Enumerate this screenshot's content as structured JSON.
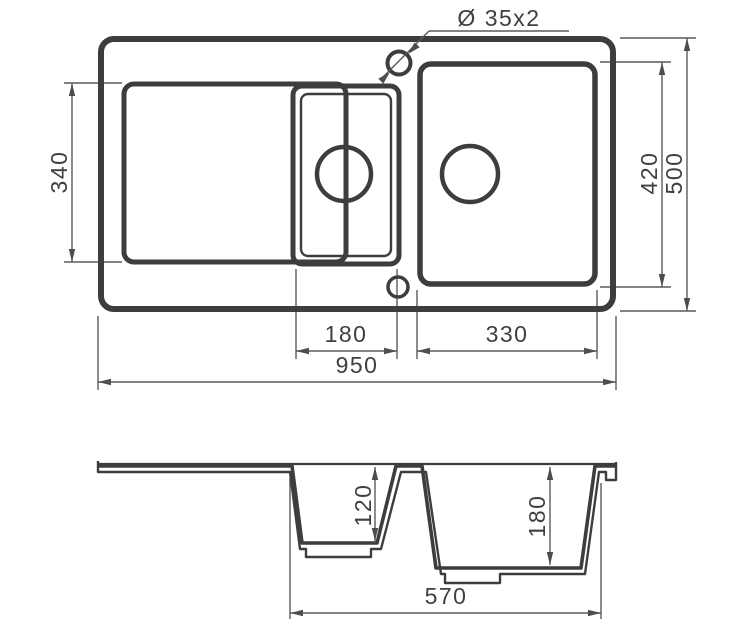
{
  "drawing": {
    "type": "technical-drawing",
    "subject": "double-bowl kitchen sink with drainboard, top view and cross-section",
    "labels": {
      "tap_holes": "Ø 35x2"
    },
    "top_view": {
      "drainboard_length": "340",
      "bowl_length": "420",
      "overall_length": "500",
      "half_bowl_width": "180",
      "main_bowl_width": "330",
      "overall_width": "950"
    },
    "section_view": {
      "half_bowl_depth": "120",
      "main_bowl_depth": "180",
      "bowls_overall_width": "570"
    }
  },
  "colors": {
    "outline": "#3d3d3d",
    "dimension": "#5a5a5a",
    "text": "#3f3f3f",
    "background": "#ffffff"
  }
}
